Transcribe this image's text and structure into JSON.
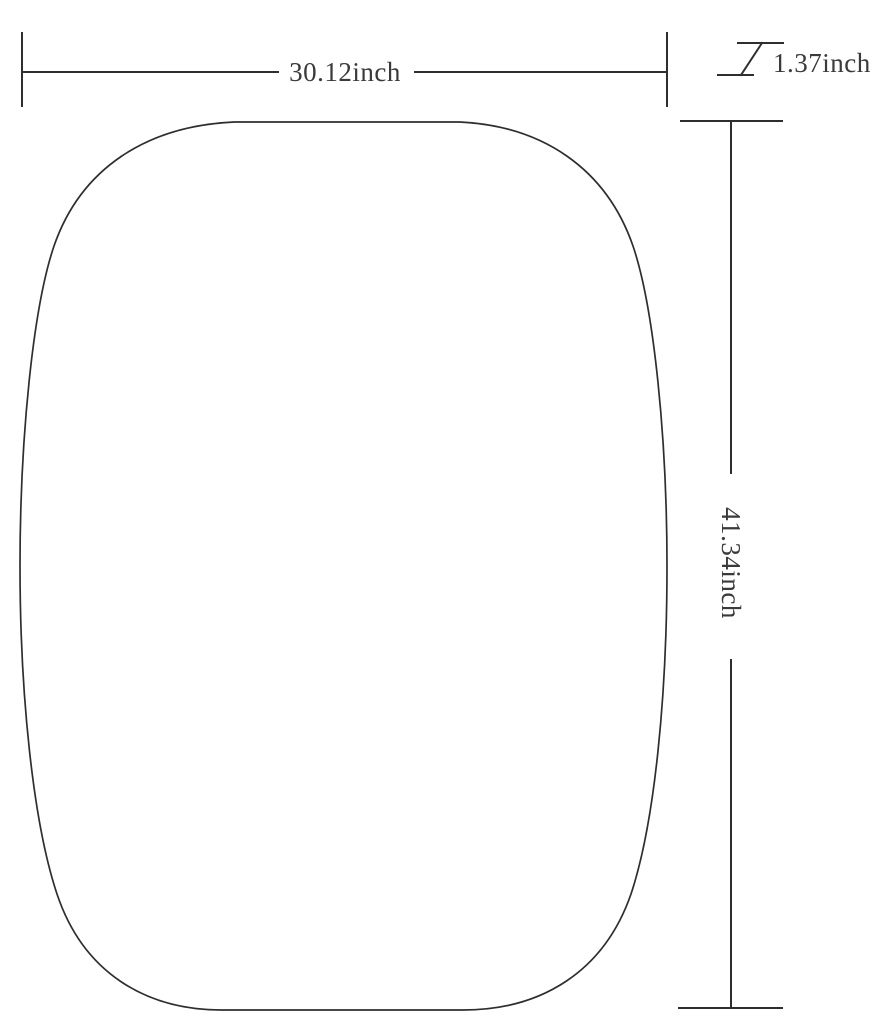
{
  "page": {
    "background_color": "#ffffff",
    "line_color": "#2e2e2e",
    "text_color": "#3a3a3a"
  },
  "diagram": {
    "shape": "rounded-barrel-panel-outline",
    "dimensions": {
      "width_label": "30.12inch",
      "height_label": "41.34inch",
      "thickness_label": "1.37inch"
    }
  }
}
